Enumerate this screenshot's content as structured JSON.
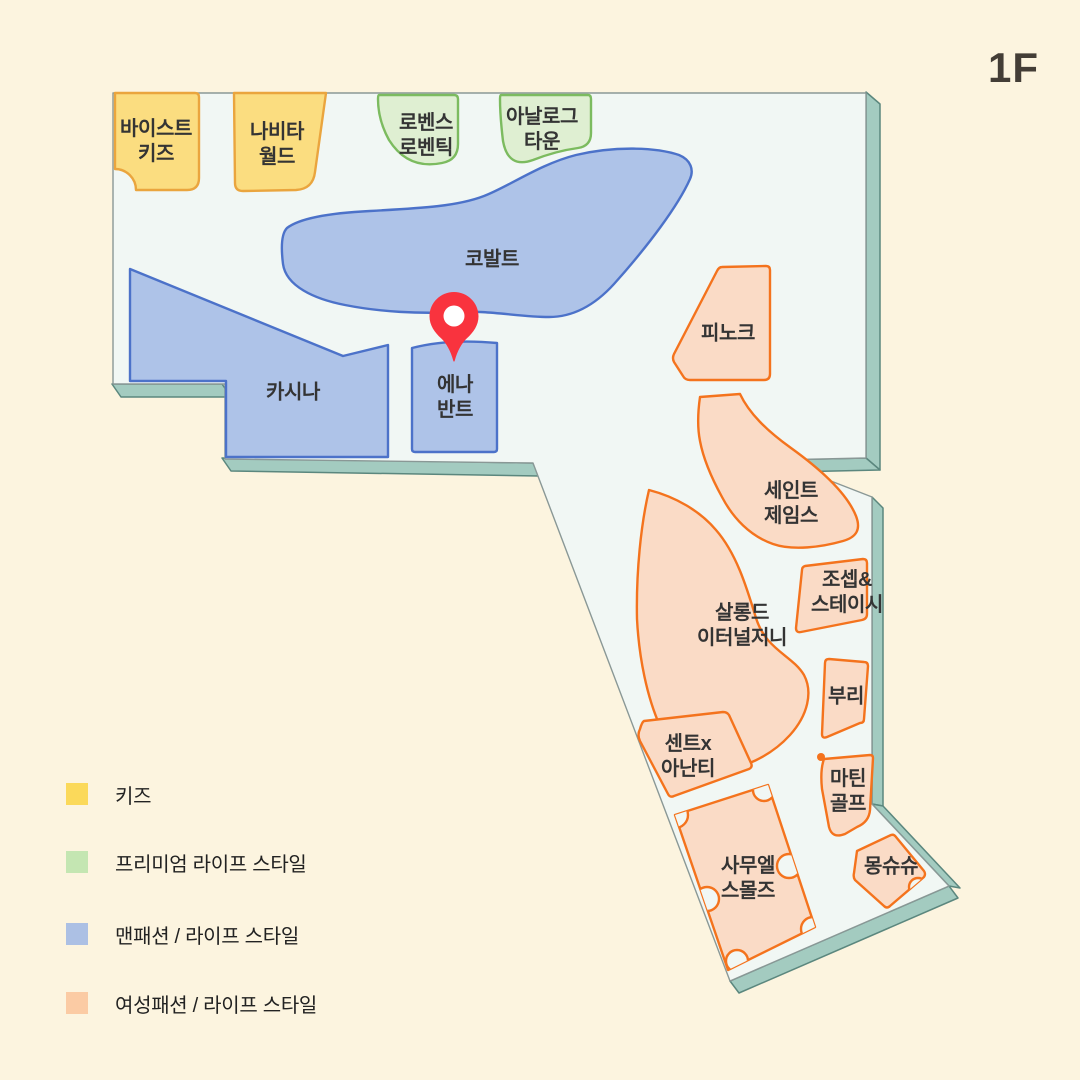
{
  "floor_label": "1F",
  "map": {
    "shops": [
      {
        "id": "vist-kids",
        "category": "kids",
        "lines": [
          "바이스트",
          "키즈"
        ]
      },
      {
        "id": "navita-world",
        "category": "kids",
        "lines": [
          "나비타",
          "월드"
        ]
      },
      {
        "id": "lovens-loventic",
        "category": "premium",
        "lines": [
          "로벤스",
          "로벤틱"
        ]
      },
      {
        "id": "analog-town",
        "category": "premium",
        "lines": [
          "아날로그",
          "타운"
        ]
      },
      {
        "id": "cobalt",
        "category": "men",
        "lines": [
          "코발트"
        ]
      },
      {
        "id": "cassina",
        "category": "men",
        "lines": [
          "카시나"
        ]
      },
      {
        "id": "ena-vant",
        "category": "men",
        "lines": [
          "에나",
          "반트"
        ]
      },
      {
        "id": "pinoke",
        "category": "women",
        "lines": [
          "피노크"
        ]
      },
      {
        "id": "saint-james",
        "category": "women",
        "lines": [
          "세인트",
          "제임스"
        ]
      },
      {
        "id": "joseph-stacey",
        "category": "women",
        "lines": [
          "조셉&",
          "스테이시"
        ]
      },
      {
        "id": "salon-de-eternal-journey",
        "category": "women",
        "lines": [
          "살롱드",
          "이터널저니"
        ]
      },
      {
        "id": "buri",
        "category": "women",
        "lines": [
          "부리"
        ]
      },
      {
        "id": "scent-x-ananti",
        "category": "women",
        "lines": [
          "센트x",
          "아난티"
        ]
      },
      {
        "id": "martin-golf",
        "category": "women",
        "lines": [
          "마틴",
          "골프"
        ]
      },
      {
        "id": "samuel-smalls",
        "category": "women",
        "lines": [
          "사무엘",
          "스몰즈"
        ]
      },
      {
        "id": "mon-chouchou",
        "category": "women",
        "lines": [
          "몽슈슈"
        ]
      }
    ],
    "marker": {
      "color": "#f9333e"
    }
  },
  "legend": {
    "items": [
      {
        "label": "키즈",
        "color": "#fbd95a"
      },
      {
        "label": "프리미엄 라이프 스타일",
        "color": "#c4e6b2"
      },
      {
        "label": "맨패션 / 라이프 스타일",
        "color": "#acc0e4"
      },
      {
        "label": "여성패션 / 라이프 스타일",
        "color": "#fbcba4"
      }
    ]
  },
  "colors": {
    "background": "#fcf4df",
    "floor": "#f1f7f4",
    "floor_outline": "#8a9896",
    "floor_edge": "#a3cbc0",
    "floor_edge_outline": "#5b877e",
    "pin": "#f9333e",
    "label_text": "#343434",
    "categories": {
      "kids": {
        "fill": "#fbdd80",
        "stroke": "#eaa53e"
      },
      "premium": {
        "fill": "#dfefd2",
        "stroke": "#7cbb5f"
      },
      "men": {
        "fill": "#aec3e8",
        "stroke": "#4c72c9"
      },
      "women": {
        "fill": "#fadbc6",
        "stroke": "#f4731d"
      }
    }
  }
}
